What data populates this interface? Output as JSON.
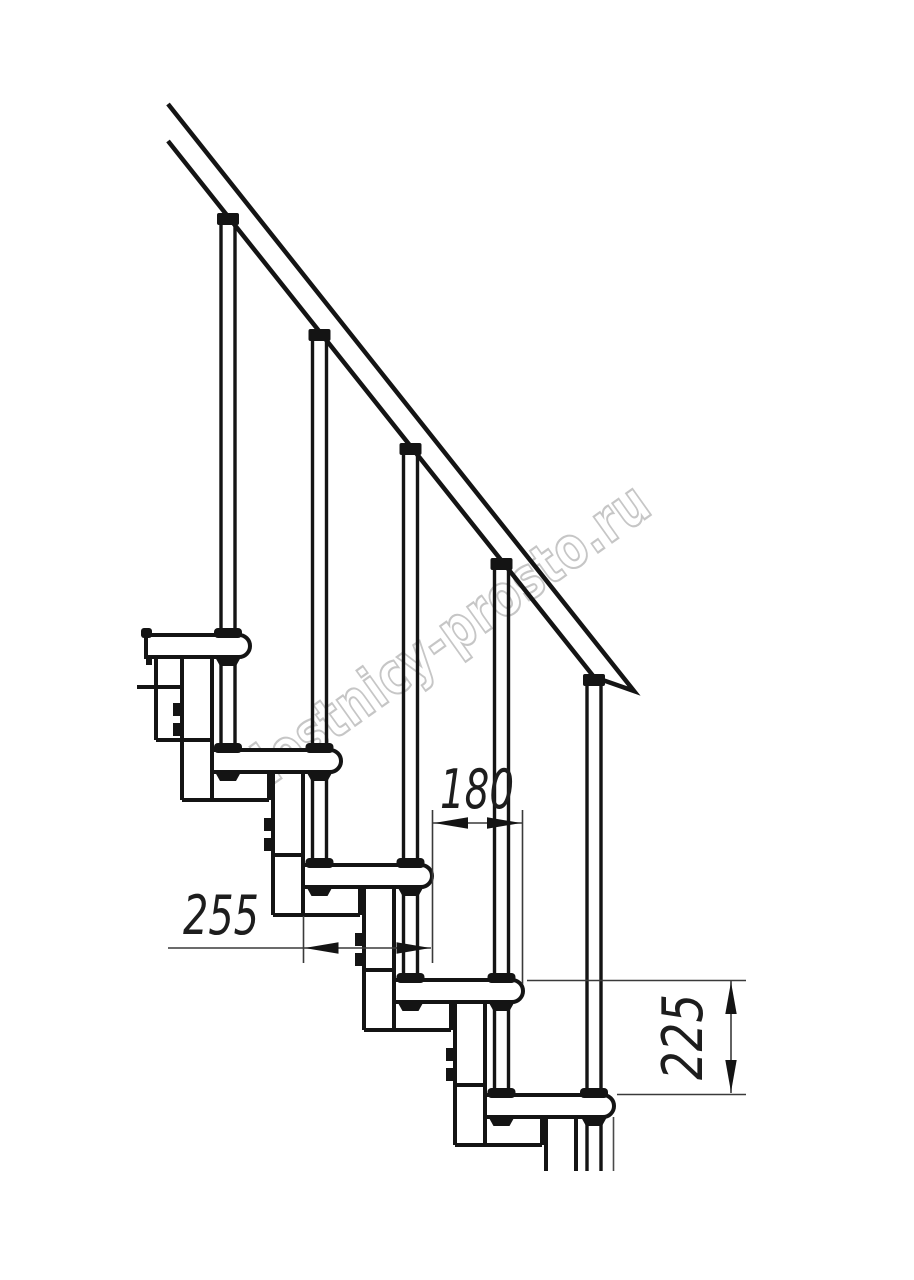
{
  "drawing": {
    "title": "staircase-side-elevation",
    "watermark": "lestnicy-prosto.ru",
    "dims": {
      "run": {
        "value": "180",
        "meaning": "horizontal step offset, mm"
      },
      "depth": {
        "value": "255",
        "meaning": "tread depth, mm"
      },
      "rise": {
        "value": "225",
        "meaning": "step rise, mm"
      }
    },
    "colors": {
      "line": "#141414",
      "dimension_line": "#3a3a3a",
      "watermark": "#c4c4c4",
      "background": "#ffffff"
    }
  }
}
